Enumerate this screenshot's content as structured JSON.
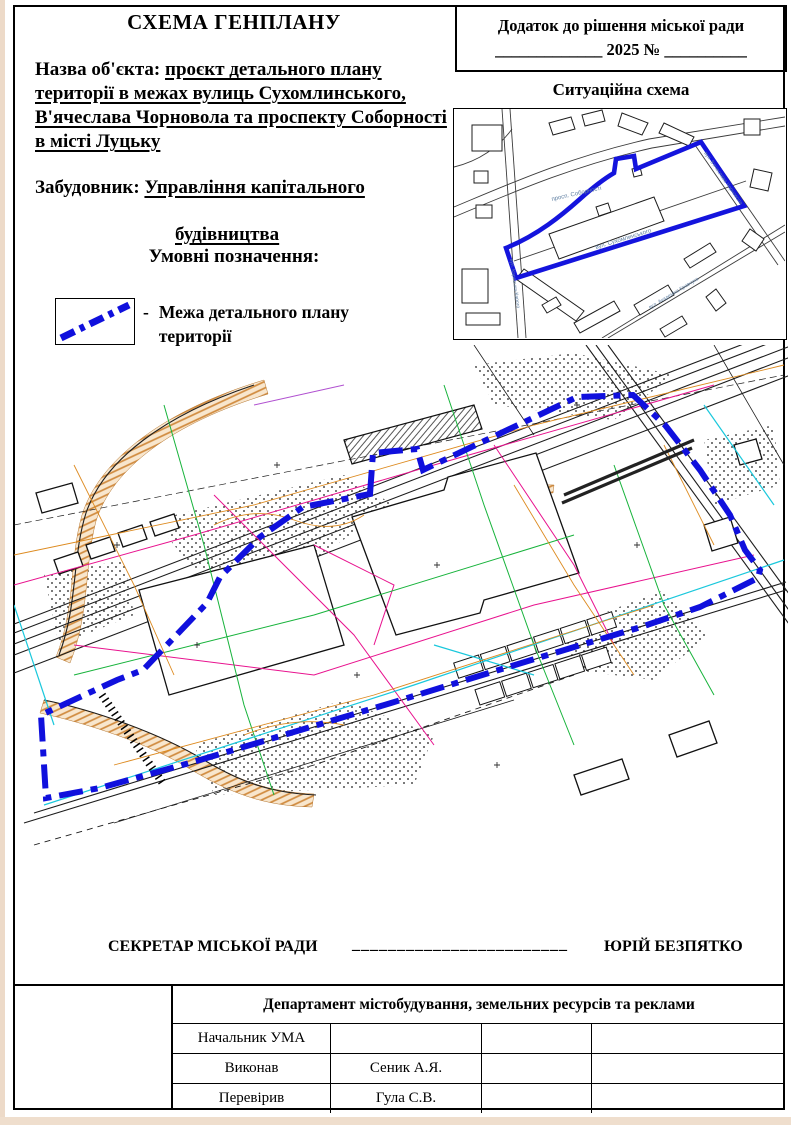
{
  "document": {
    "title": "СХЕМА ГЕНПЛАНУ",
    "annex": {
      "line1": "Додаток до рішення міської ради",
      "line2": "_____________ 2025 № __________"
    },
    "object_name": {
      "label": "Назва об'єкта:",
      "value": "проєкт детального плану території в межах вулиць Сухомлинського, В'ячеслава Чорновола та проспекту Соборності в місті Луцьку"
    },
    "developer": {
      "label": "Забудовник:",
      "value_line1": "Управління капітального",
      "value_line2": "будівництва"
    },
    "legend": {
      "title": "Умовні позначення:",
      "items": [
        {
          "bullet": "-",
          "label": "Межа детального плану території",
          "symbol": "blue-dash-dot-boundary-line",
          "color": "#1010dd"
        }
      ]
    },
    "situation_map": {
      "title": "Ситуаційна схема",
      "streets": {
        "sobornosti": "просп. Соборності",
        "sukhomlynskoho": "вул. Сухомлинського",
        "chornovola": "вул. В'ячеслава Чорновола",
        "kravchuka": "вул. Академіка Кравчука",
        "karpenka_karoho": "вул. Карпенка-Карого"
      }
    },
    "signature": {
      "role": "СЕКРЕТАР МІСЬКОЇ РАДИ",
      "line": "________________________",
      "name": "ЮРІЙ БЕЗПЯТКО"
    },
    "approval_table": {
      "department": "Департамент містобудування, земельних ресурсів та реклами",
      "rows": [
        {
          "role": "Начальник УМА",
          "name": "",
          "c3": "",
          "c4": ""
        },
        {
          "role": "Виконав",
          "name": "Сеник А.Я.",
          "c3": "",
          "c4": ""
        },
        {
          "role": "Перевірив",
          "name": "Гула С.В.",
          "c3": "",
          "c4": ""
        }
      ]
    },
    "map_colors": {
      "boundary_blue": "#1010dd",
      "utility_magenta": "#e8128e",
      "utility_green": "#17b33b",
      "utility_cyan": "#1ac8dc",
      "relief_orange": "#dd8a1f",
      "slope_tan": "#e9b780"
    }
  }
}
